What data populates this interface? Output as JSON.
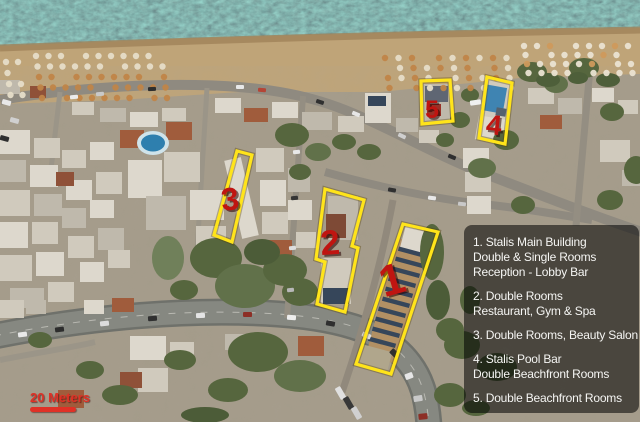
{
  "map": {
    "scale": {
      "label": "20 Meters"
    },
    "colors": {
      "outline": "#ffe41a",
      "marker": "#bf1511",
      "legend_bg": "rgba(0,0,0,0.55)",
      "legend_text": "#f5f5f3",
      "scale_red": "#e03126"
    },
    "markers": [
      {
        "n": "1",
        "x": 392,
        "y": 280,
        "size": 44,
        "rot": -16
      },
      {
        "n": "2",
        "x": 330,
        "y": 243,
        "size": 35,
        "rot": -4
      },
      {
        "n": "3",
        "x": 230,
        "y": 199,
        "size": 32,
        "rot": -6
      },
      {
        "n": "4",
        "x": 494,
        "y": 125,
        "size": 28,
        "rot": 6
      },
      {
        "n": "5",
        "x": 432,
        "y": 110,
        "size": 25,
        "rot": 0
      }
    ],
    "outlines": [
      {
        "id": "1",
        "points": "403,224 438,232 391,374 356,364"
      },
      {
        "id": "2",
        "points": "325,189 364,200 352,246 358,248 345,312 317,304 325,262 316,259"
      },
      {
        "id": "3",
        "points": "237,151 252,155 232,242 214,235"
      },
      {
        "id": "4",
        "points": "487,77 512,83 505,144 479,138"
      },
      {
        "id": "5",
        "points": "421,81 450,80 453,121 422,124"
      }
    ]
  },
  "legend": {
    "items": [
      {
        "lines": [
          "1. Stalis Main Building",
          "Double & Single Rooms",
          "Reception - Lobby Bar"
        ]
      },
      {
        "lines": [
          "2. Double Rooms",
          "Restaurant, Gym & Spa"
        ]
      },
      {
        "lines": [
          "3. Double Rooms, Beauty Salon"
        ]
      },
      {
        "lines": [
          "4. Stalis Pool Bar",
          "Double Beachfront Rooms"
        ]
      },
      {
        "lines": [
          "5. Double Beachfront Rooms"
        ]
      }
    ]
  }
}
